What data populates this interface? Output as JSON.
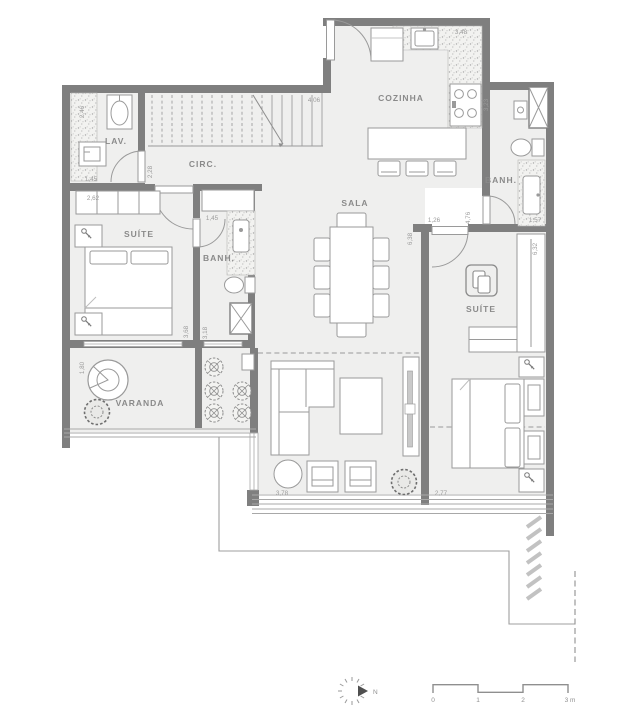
{
  "rooms": {
    "lav": "LAV.",
    "circ": "CIRC.",
    "cozinha": "COZINHA",
    "sala": "SALA",
    "suite_left": "SUÍTE",
    "banh_left": "BANH.",
    "banh_right": "BANH.",
    "suite_right": "SUÍTE",
    "varanda": "VARANDA"
  },
  "dims": {
    "lav_h": "2,46",
    "lav_w": "1,45",
    "suite_left_w": "2,62",
    "circ_w": "2,28",
    "stairs_l": "4,06",
    "kitchen_w": "3,48",
    "service_h": "3,23",
    "banh_left_w": "1,45",
    "banh_right_w": "1,57",
    "east_hall_h": "4,76",
    "door_offset": "1,26",
    "suite_right_h": "6,32",
    "living_h": "6,38",
    "suite_left_h": "3,68",
    "banh_left_h": "3,18",
    "varanda_h": "1,80",
    "living_w": "3,78",
    "suite_right_w": "2,77"
  },
  "scale": {
    "t0": "0",
    "t1": "1",
    "t2": "2",
    "t3": "3 m"
  },
  "compass": {
    "north": "N"
  },
  "colors": {
    "wall": "#7f7f7f",
    "floor": "#efefee",
    "line": "#a8a8a8",
    "text": "#9b9b9b"
  }
}
